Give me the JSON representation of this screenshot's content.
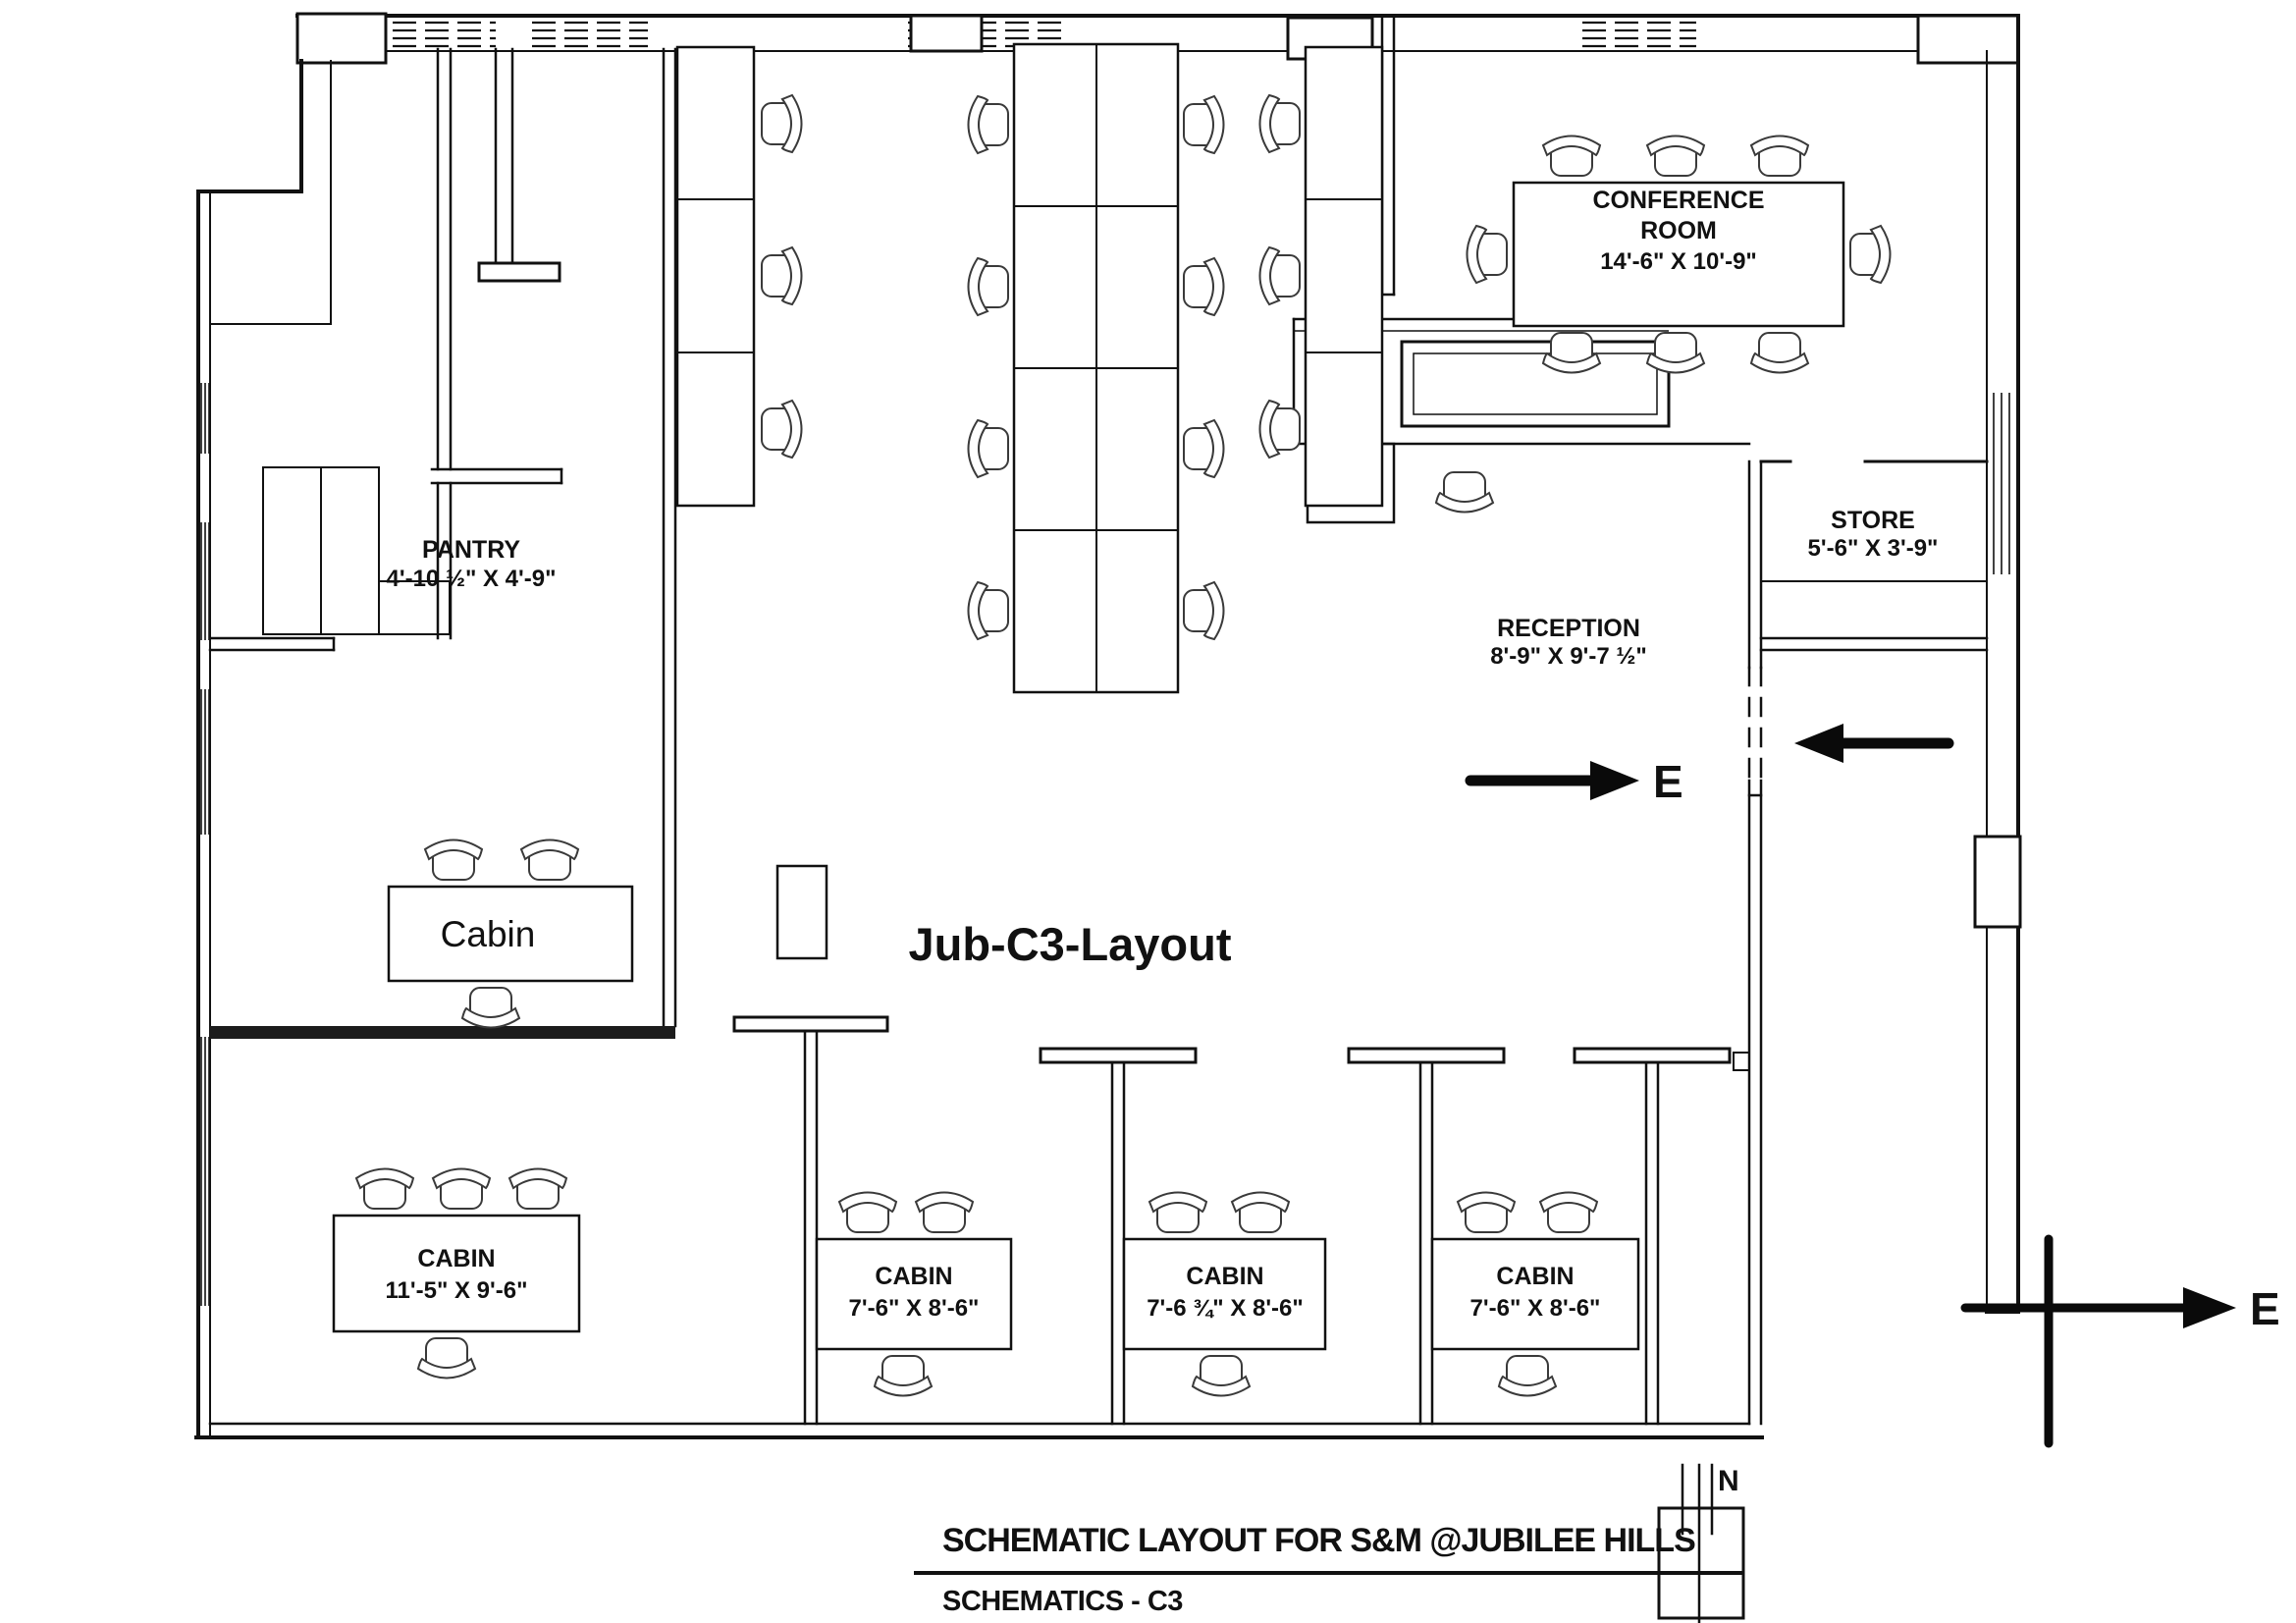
{
  "drawing": {
    "plan_title": "Jub-C3-Layout",
    "rooms": {
      "pantry": {
        "name": "PANTRY",
        "dims": "4'-10 ½\" X 4'-9\""
      },
      "conference": {
        "line1": "CONFERENCE",
        "line2": "ROOM",
        "dims": "14'-6\" X 10'-9\""
      },
      "store": {
        "name": "STORE",
        "dims": "5'-6\" X 3'-9\""
      },
      "reception": {
        "name": "RECEPTION",
        "dims": "8'-9\" X 9'-7 ½\""
      },
      "cabin_mid": {
        "name": "Cabin"
      },
      "cabin1": {
        "name": "CABIN",
        "dims": "11'-5\" X 9'-6\""
      },
      "cabin2": {
        "name": "CABIN",
        "dims": "7'-6\" X 8'-6\""
      },
      "cabin3": {
        "name": "CABIN",
        "dims": "7'-6 ¾\" X 8'-6\""
      },
      "cabin4": {
        "name": "CABIN",
        "dims": "7'-6\" X 8'-6\""
      }
    },
    "annotations": {
      "east": "E",
      "north": "N"
    },
    "title_block": {
      "title": "SCHEMATIC LAYOUT FOR S&M @JUBILEE HILLS",
      "sheet": "SCHEMATICS - C3"
    },
    "colors": {
      "ink": "#111111",
      "paper": "#ffffff"
    }
  }
}
